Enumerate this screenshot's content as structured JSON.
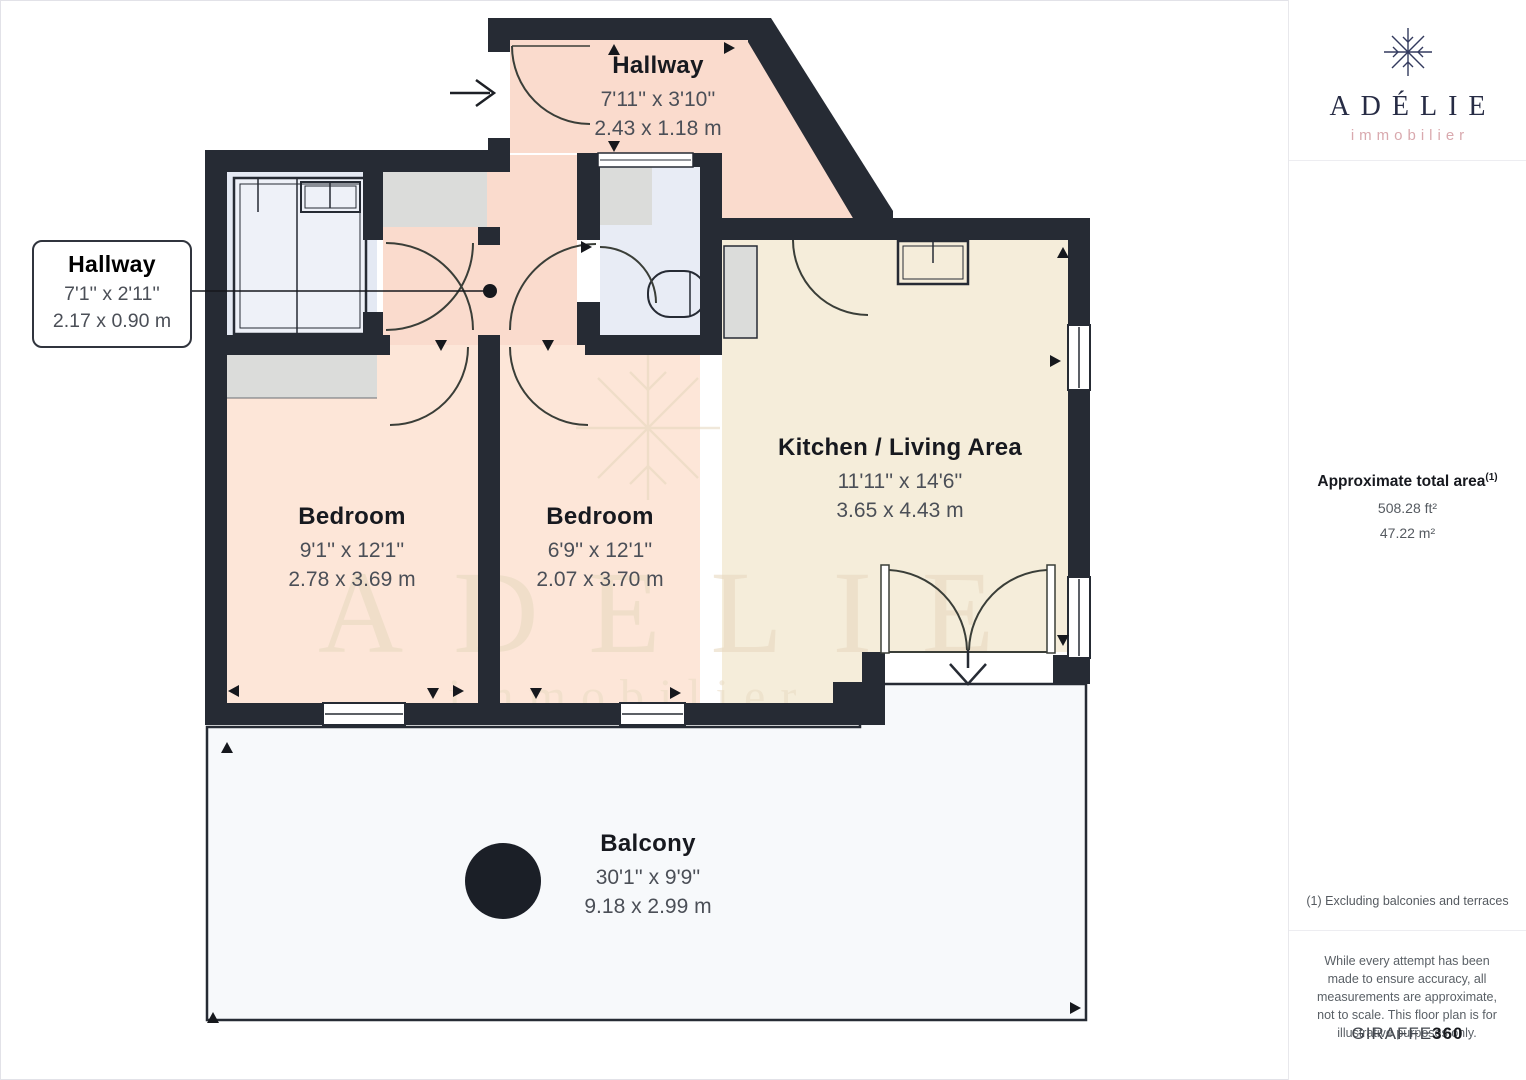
{
  "branding": {
    "name": "ADÉLIE",
    "tagline": "immobilier"
  },
  "sidebar": {
    "area_title": "Approximate total area",
    "area_superscript": "(1)",
    "area_ft": "508.28 ft²",
    "area_m": "47.22 m²",
    "footnote": "(1) Excluding balconies and terraces",
    "disclaimer": "While every attempt has been made to ensure accuracy, all measurements are approximate, not to scale. This floor plan is for illustrative purposes only.",
    "provider": {
      "name": "GIRAFFE",
      "suffix": "360"
    }
  },
  "floorplan": {
    "rooms": [
      {
        "id": "hallway-top",
        "name": "Hallway",
        "imperial": "7'11'' x 3'10''",
        "metric": "2.43 x 1.18 m"
      },
      {
        "id": "hallway-callout",
        "name": "Hallway",
        "imperial": "7'1'' x 2'11''",
        "metric": "2.17 x 0.90 m"
      },
      {
        "id": "bedroom-1",
        "name": "Bedroom",
        "imperial": "9'1'' x 12'1''",
        "metric": "2.78 x 3.69 m"
      },
      {
        "id": "bedroom-2",
        "name": "Bedroom",
        "imperial": "6'9'' x 12'1''",
        "metric": "2.07 x 3.70 m"
      },
      {
        "id": "kitchen-living",
        "name": "Kitchen / Living Area",
        "imperial": "11'11'' x 14'6''",
        "metric": "3.65 x 4.43 m"
      },
      {
        "id": "balcony",
        "name": "Balcony",
        "imperial": "30'1'' x 9'9''",
        "metric": "9.18 x 2.99 m"
      }
    ],
    "watermark": {
      "line1": "ADELIE",
      "line2": "immobilier"
    },
    "colors": {
      "wall": "#262b34",
      "hallway": "#fadbcd",
      "bedroom": "#fde6d8",
      "kitchen": "#f5edda",
      "bathroom": "#e8ecf5",
      "furnished_room": "#e4e9f3",
      "closet": "#dbdcda",
      "balcony": "#f7f9fb",
      "accent_rose": "#d9a9ae",
      "navy": "#272c45"
    }
  }
}
